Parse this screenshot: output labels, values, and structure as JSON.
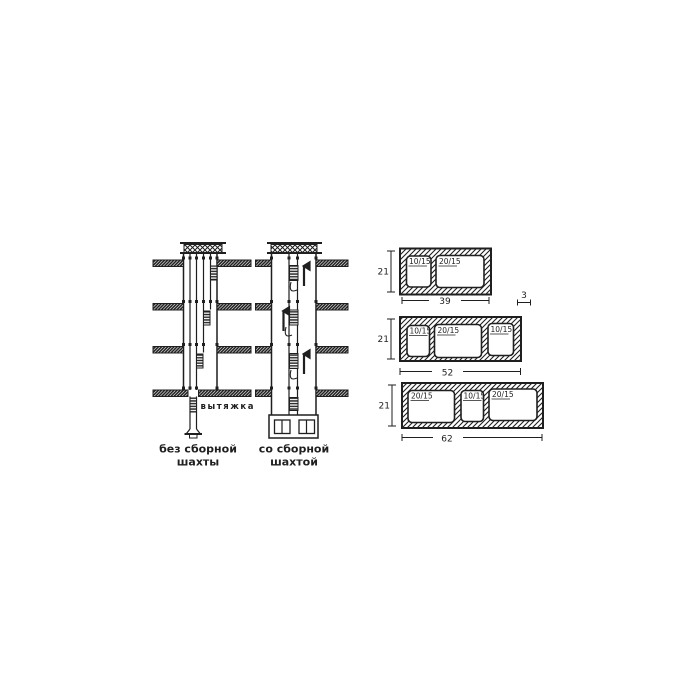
{
  "palette": {
    "paper": "#ffffff",
    "ink": "#1f1f1f"
  },
  "shaft_diagrams": {
    "exhaust_label": "вытяжка",
    "without_shaft": {
      "caption": [
        "без сборной",
        "шахты"
      ]
    },
    "with_shaft": {
      "caption": [
        "со сборной",
        "шахтой"
      ]
    }
  },
  "block_sections": {
    "wall_thickness": "3",
    "blocks": [
      {
        "height": "21",
        "width": "39",
        "cells": [
          "10/15",
          "20/15"
        ]
      },
      {
        "height": "21",
        "width": "52",
        "cells": [
          "10/15",
          "20/15",
          "10/15"
        ]
      },
      {
        "height": "21",
        "width": "62",
        "cells": [
          "20/15",
          "10/15",
          "20/15"
        ]
      }
    ]
  }
}
